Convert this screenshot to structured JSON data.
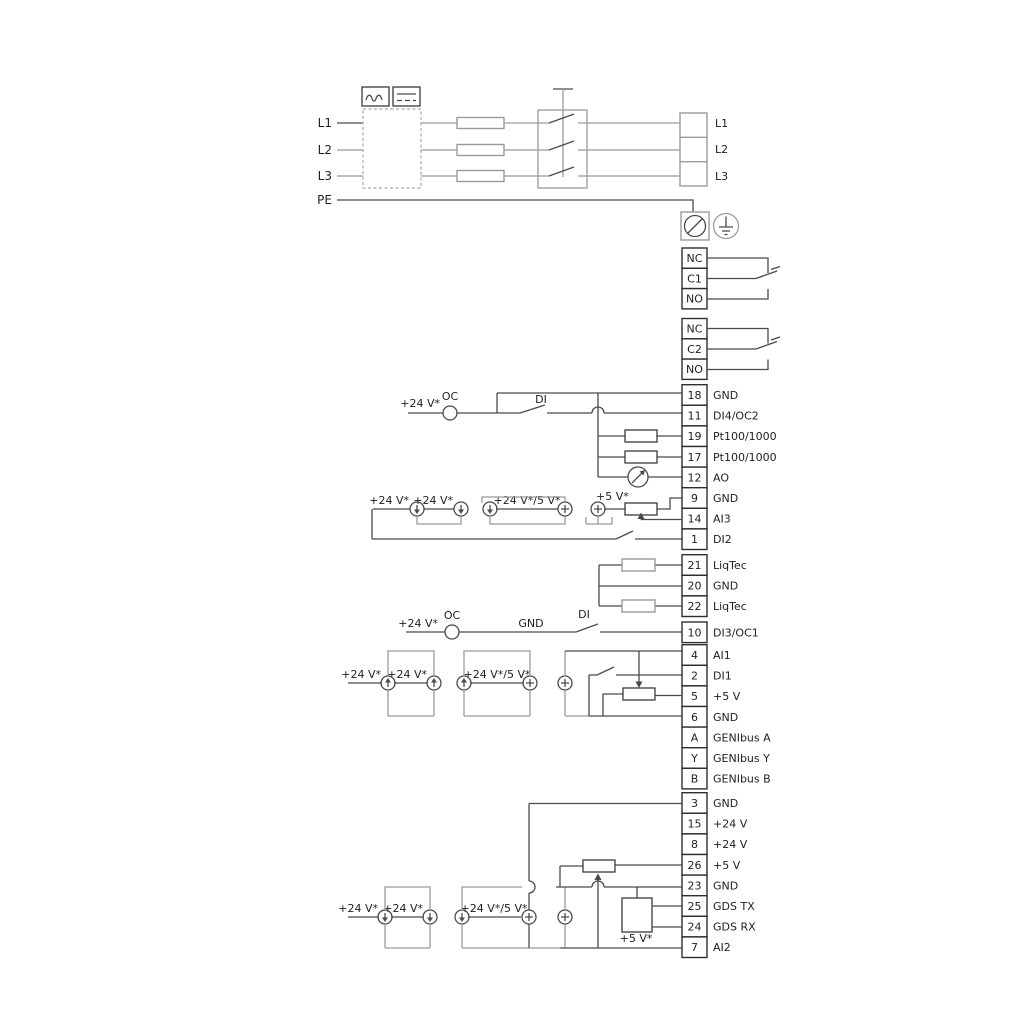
{
  "power": {
    "input_labels": [
      "L1",
      "L2",
      "L3",
      "PE"
    ],
    "output_terminals": [
      "L1",
      "L2",
      "L3"
    ],
    "converter_icons": [
      "ac-icon",
      "dc-icon"
    ]
  },
  "relays": [
    {
      "rows": [
        "NC",
        "C1",
        "NO"
      ]
    },
    {
      "rows": [
        "NC",
        "C2",
        "NO"
      ]
    }
  ],
  "strips": [
    {
      "id": "io-top",
      "rows": [
        {
          "num": "18",
          "label": "GND"
        },
        {
          "num": "11",
          "label": "DI4/OC2"
        },
        {
          "num": "19",
          "label": "Pt100/1000"
        },
        {
          "num": "17",
          "label": "Pt100/1000"
        },
        {
          "num": "12",
          "label": "AO"
        },
        {
          "num": "9",
          "label": "GND"
        },
        {
          "num": "14",
          "label": "AI3"
        },
        {
          "num": "1",
          "label": "DI2"
        }
      ]
    },
    {
      "id": "liqtec",
      "rows": [
        {
          "num": "21",
          "label": "LiqTec"
        },
        {
          "num": "20",
          "label": "GND"
        },
        {
          "num": "22",
          "label": "LiqTec"
        }
      ]
    },
    {
      "id": "di3",
      "rows": [
        {
          "num": "10",
          "label": "DI3/OC1"
        }
      ]
    },
    {
      "id": "io-mid",
      "rows": [
        {
          "num": "4",
          "label": "AI1"
        },
        {
          "num": "2",
          "label": "DI1"
        },
        {
          "num": "5",
          "label": "+5 V"
        },
        {
          "num": "6",
          "label": "GND"
        },
        {
          "num": "A",
          "label": "GENIbus A"
        },
        {
          "num": "Y",
          "label": "GENIbus Y"
        },
        {
          "num": "B",
          "label": "GENIbus B"
        }
      ]
    },
    {
      "id": "io-bottom",
      "rows": [
        {
          "num": "3",
          "label": "GND"
        },
        {
          "num": "15",
          "label": "+24 V"
        },
        {
          "num": "8",
          "label": "+24 V"
        },
        {
          "num": "26",
          "label": "+5 V"
        },
        {
          "num": "23",
          "label": "GND"
        },
        {
          "num": "25",
          "label": "GDS TX"
        },
        {
          "num": "24",
          "label": "GDS RX"
        },
        {
          "num": "7",
          "label": "AI2"
        }
      ]
    }
  ],
  "annotations": {
    "di4": {
      "v24": "+24 V*",
      "oc": "OC",
      "di": "DI"
    },
    "ai3": {
      "v24_a": "+24 V*",
      "v24_b": "+24 V*",
      "v24_5": "+24 V*/5 V*",
      "v5": "+5 V*"
    },
    "di3": {
      "v24": "+24 V*",
      "oc": "OC",
      "gnd": "GND",
      "di": "DI"
    },
    "ai1": {
      "v24_a": "+24 V*",
      "v24_b": "+24 V*",
      "v24_5": "+24 V*/5 V*"
    },
    "ai2": {
      "v24_a": "+24 V*",
      "v24_b": "+24 V*",
      "v24_5": "+24 V*/5 V*",
      "v5": "+5 V*"
    }
  }
}
